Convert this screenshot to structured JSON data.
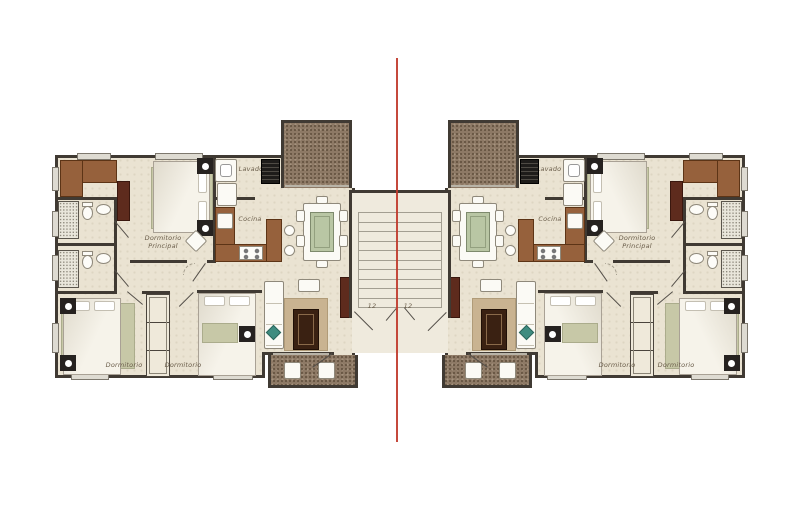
{
  "plan": {
    "type": "residential-floor-plan",
    "units": [
      "left-apartment",
      "right-apartment"
    ],
    "labels": {
      "master_bedroom_line1": "Dormitorio",
      "master_bedroom_line2": "Principal",
      "laundry": "Lavado",
      "kitchen": "Cocina",
      "bedroom_a": "Dormitorio",
      "bedroom_b": "Dormitorio"
    },
    "stairs": {
      "run_left_label": "12",
      "run_right_label": "12"
    },
    "colors": {
      "floor": "#eae3d2",
      "wall": "#403a33",
      "stone_terrace": "#8d7965",
      "wood_cabinet": "#96613c",
      "wood_dark": "#5e2b1d",
      "rug_green": "#c7c8a7",
      "rug_tan": "#c9b391",
      "symmetry_axis_red": "#c0392b"
    }
  }
}
